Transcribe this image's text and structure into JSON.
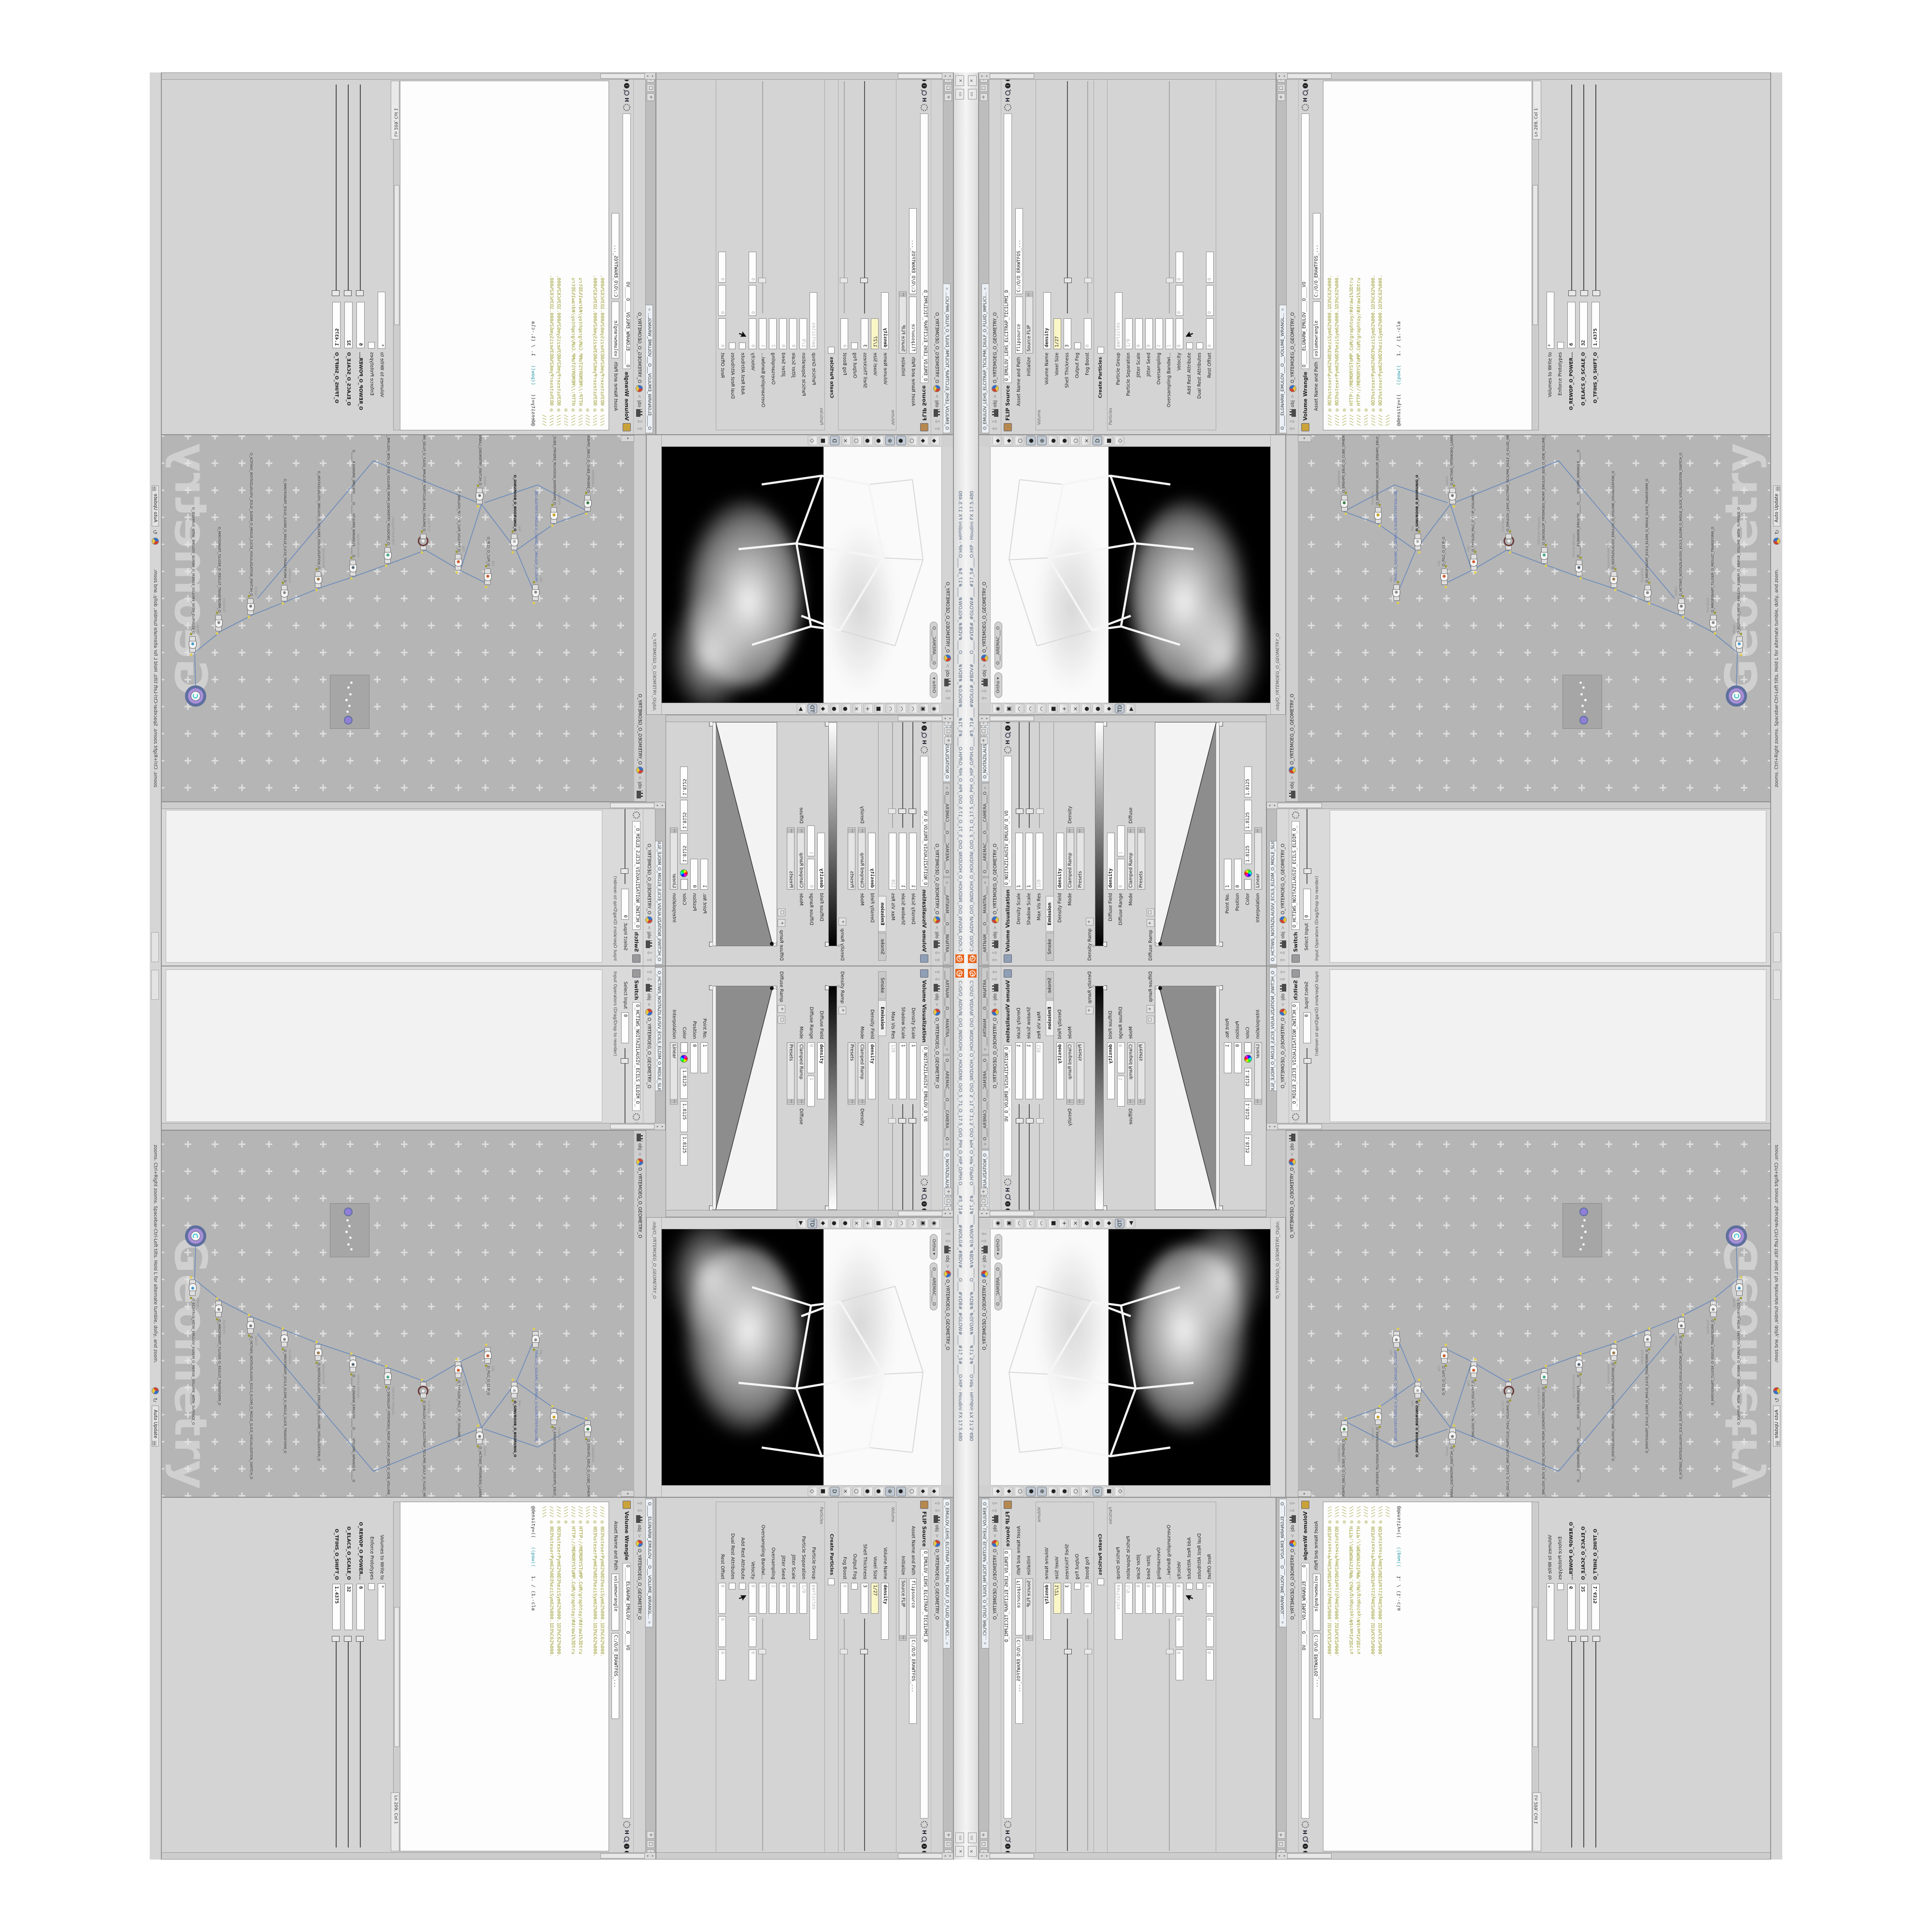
{
  "window": {
    "title": "C:/O/O_AIDIVN_O/O_INIDUOH_O_HOUDINI_O/O_5_71_O_17.5_O/O_PIH_O_HIP_O/PIH.O____#5_71#____#WOLG#_#BDV#____O____#VDB#_#GLOW#____#17_5#____O.HIP - Houdini FX 17.5.480",
    "minimize_label": "▭",
    "close_label": "×"
  },
  "breadcrumb": {
    "up_arrow": "⇧",
    "down_arrow": "⇩",
    "context": "obj",
    "chevron": ">",
    "path": "O_YRTEMOEG_O_GEOMETRY_O"
  },
  "pane_controls": {
    "pin": "+",
    "maximize": "□",
    "collapse": "◁"
  },
  "volviz": {
    "tabs": [
      {
        "label": "____ARTNAM____O____MANTRA____",
        "x": "×"
      },
      {
        "label": "O____AREMAC____O____CAMERA____O",
        "x": "×"
      },
      {
        "label": "O_NOITAZILAUSIV_E...",
        "x": "×",
        "act": "1"
      }
    ],
    "header": {
      "title": "Volume Visualization",
      "name": "O_NOITAZILAUSIV_EMULOV_O_VO"
    },
    "rows1": [
      {
        "label": "Density Scale",
        "v1": "1",
        "cls": "sl"
      },
      {
        "label": "Shadow Scale",
        "v1": "1",
        "cls": "sl"
      },
      {
        "label": "Max Vis Res",
        "v1": "128",
        "cls": "sl dis"
      }
    ],
    "folder_tabs": [
      {
        "label": "Smoke"
      },
      {
        "label": "Emission",
        "act": "1"
      }
    ],
    "rows2": [
      {
        "label": "Density Field",
        "v1": "density",
        "cls": "bold1"
      },
      {
        "label": "Mode",
        "v1": "Clamped Ramp",
        "v2": "Density",
        "cls": "drop p2"
      },
      {
        "label": "",
        "v1": "Presets",
        "cls": "drop"
      }
    ],
    "density_ramp_label": "Density Ramp",
    "rows3": [
      {
        "label": "Diffuse Field",
        "v1": "density",
        "cls": "bold1"
      },
      {
        "label": "Diffuse Range",
        "v1": "0",
        "v2": "1",
        "cls": "dis nar"
      },
      {
        "label": "Mode",
        "v1": "Clamped Ramp",
        "v2": "Diffuse",
        "cls": "drop p2"
      },
      {
        "label": "",
        "v1": "Presets",
        "cls": "drop"
      }
    ],
    "diffuse_ramp_label": "Diffuse Ramp",
    "ramp_add": "+",
    "ramp_del": "□",
    "ramp_marker": "▽",
    "rows4": [
      {
        "label": "Point No.",
        "v1": "1",
        "cls": "nar"
      },
      {
        "label": "Position",
        "v1": "0",
        "cls": "nar"
      }
    ],
    "color": {
      "label": "Color",
      "r": "1.8125",
      "g": "1.8125",
      "b": "1.8125"
    },
    "rows5": [
      {
        "label": "Interpolation",
        "v1": "Linear",
        "cls": "drop"
      }
    ]
  },
  "viewport": {
    "pills": [
      {
        "label": "Ortho ▾"
      },
      {
        "label": "O___AREMAC___O"
      }
    ],
    "path": "/obj/O_YRTEMOEG_O_GEOMETRY_O",
    "left_icons": [
      {
        "g": "◉",
        "c": "#666"
      },
      {
        "g": "▣",
        "c": "#888"
      },
      {
        "g": "◠",
        "c": "#b03a2e"
      },
      {
        "g": "◠",
        "c": "#b03a2e"
      },
      {
        "g": "◠",
        "c": "#b03a2e"
      },
      {
        "g": "■",
        "c": "#b03a2e"
      },
      {
        "g": "+",
        "c": "#3a7d44"
      },
      {
        "g": "×",
        "c": "#c9c0c0"
      },
      {
        "g": "●",
        "c": "#aa3333"
      },
      {
        "g": "●",
        "c": "#888888"
      },
      {
        "g": "◆",
        "c": "#cc2222"
      },
      {
        "g": "TD",
        "c": "#445566",
        "p": "1"
      },
      {
        "g": "▶",
        "c": "#999999"
      }
    ],
    "right_icons": [
      {
        "g": "◆",
        "c": "#9a9a9a"
      },
      {
        "g": "◆",
        "c": "#9a9a9a"
      },
      {
        "g": "○",
        "c": "#888888"
      },
      {
        "g": "●",
        "c": "#555555",
        "p": "1"
      },
      {
        "g": "⊕",
        "c": "#444444",
        "p": "1"
      },
      {
        "g": "●",
        "c": "#d8bc3a"
      },
      {
        "g": "●",
        "c": "#aaaaaa"
      },
      {
        "g": "○",
        "c": "#777777"
      },
      {
        "g": "×",
        "c": "#666666"
      },
      {
        "g": "D",
        "c": "#335566",
        "p": "1"
      },
      {
        "g": "■",
        "c": "#4a8f3c"
      },
      {
        "g": "◇",
        "c": "#c9ad3f"
      }
    ],
    "wire_main": "M150 210 L300 120 L452 150 L470 248 L330 300 L158 270 Z M158 270 L120 392 M330 300 L318 420 M470 248 L452 372 M150 210 L180 290 M300 120 L330 300",
    "wire_faint": "M150 210 L118 96 M300 120 L296 38 M452 150 L462 60 M118 96 L296 38 L462 60"
  },
  "flip": {
    "tab": {
      "label": "O_EMULOV_LEHS_ELCITRAP_TICILPMI_DIULF_O_FLUID_IMPLICI...",
      "x": "×"
    },
    "header": {
      "title": "FLIP Source",
      "name": "O_EMULOV_LEHS_ELCITRAP_TICILPMI_D"
    },
    "rows1": [
      {
        "label": "Asset Name and Path",
        "v1": "flipsource",
        "v2": "C:/O/O_ERAWTFOS_...",
        "cls": "wide"
      },
      {
        "label": "Initialize",
        "v1": "Source FLIP",
        "cls": "drop"
      }
    ],
    "frame1": "Volume",
    "rows2": [
      {
        "label": "Volume Name",
        "v1": "density",
        "cls": "bold1"
      },
      {
        "label": "Voxel Size",
        "v1": "1/27",
        "cls": "yellow nar"
      },
      {
        "label": "Shell Thickness",
        "v1": "3",
        "cls": "sl nar"
      },
      {
        "label": "Output Fog",
        "cls": "cb"
      },
      {
        "label": "Fog Boost",
        "v1": "0",
        "cls": "dis sl nar"
      }
    ],
    "create_particles": "Create Particles",
    "frame2": "Particles",
    "rows3": [
      {
        "label": "Particle Group",
        "v1": "particles",
        "cls": "dis"
      },
      {
        "label": "Particle Separation",
        "v1": "1/9",
        "cls": "dis nar"
      },
      {
        "label": "Jitter Scale",
        "v1": "0",
        "cls": "dis nar"
      },
      {
        "label": "Jitter Seed",
        "v1": "0",
        "cls": "dis nar"
      },
      {
        "label": "Oversampling",
        "v1": "2",
        "cls": "dis nar"
      },
      {
        "label": "Oversampling Bandwi...",
        "v1": "1",
        "cls": "dis sl nar"
      },
      {
        "label": "Velocity",
        "v1": "0",
        "v2": "0",
        "v3": "0",
        "cls": "dis nar"
      },
      {
        "label": "Add Rest Attribute",
        "cls": "cb cursor"
      },
      {
        "label": "Dual Rest Attributes",
        "cls": "cb"
      },
      {
        "label": "Rest Offset",
        "v1": "0",
        "v2": "0",
        "v3": "0",
        "cls": "dis nar"
      }
    ]
  },
  "switch_pane": {
    "tab": {
      "label": "O_HCTIWS_NOITAZILAUSIV_ECILS_ELDIM_O_MIDLE_SLICE_VISUALIZATION...",
      "x": "×"
    },
    "header": {
      "title": "Switch",
      "name": "O_HCTIWS_NOITAZILAUSIV_ECILS_ELDIM_O_"
    },
    "rows": [
      {
        "label": "Select Input",
        "v1": "0",
        "cls": "sl nar"
      }
    ],
    "note": "Input Operators (Drag/Drop to reorder)"
  },
  "network": {
    "path": "O_YRTEMOEG_O_GEOMETRY_O",
    "watermark": "Geometry",
    "nodes": [
      {
        "type": "an_CubeSphere",
        "name": "O_EREHPS_EBUC_O_CUBE_SPHERE_O",
        "st": "left:600px;top:88px",
        "dot": "background:#3a7d44"
      },
      {
        "type": "PolyWire",
        "name": "O_EMARFERIW_NOGYLOP_EREHPS_EBUC_O_CUBE_SPHERE_POLYGON_WIREFRAME_O",
        "st": "left:575px;top:158px",
        "dot": "background:#c9a227"
      },
      {
        "type": "File",
        "name": "TRIALS.O_SQUARC_O_GENJS1_0.SLIDIRT.STEP.SQA.OBJ",
        "st": "left:415px;top:196px",
        "dot": "background:#8a8a8a",
        "cls": "blue"
      },
      {
        "type": "Box",
        "name": "O_GINUROOB_O_BOORUNIG_O",
        "st": "left:520px;top:240px",
        "dot": "background:#b0b0b0",
        "cls": "bold"
      },
      {
        "type": "Switch",
        "name": "O_HCTIWS_YRTEMOEG_LANRETXE_LANRETNI_O_INTERNAL_EXTERNAL_GEOMETRY_SWITCH_O",
        "st": "left:615px;top:312px",
        "dot": "background:#7a7a7a"
      },
      {
        "type": "Clip",
        "name": "O_PILC_O_CLIP_O",
        "st": "left:448px;top:295px",
        "dot": "background:#cc5a2a"
      },
      {
        "type": "Clip",
        "name": "O_EMULOV_PILC_O_CLIP_VOLUME_O",
        "st": "left:478px;top:356px",
        "dot": "background:#cc5a2a"
      },
      {
        "type": "FLIP Source",
        "name": "O_EMULOV_LEHS_ELCITRAP_TICILPMI_DIULF_O_FLUID_IMPLICIT_PARTICLE_SHEL_VOLUME_O",
        "st": "left:520px;top:428px",
        "dot": "background:#f0f0f0",
        "cls": "ring"
      },
      {
        "type": "VDB from Polygons",
        "name": "O_SNOGILOP_YRTEMOEG_MORF_EMULOV_BDV_O_VDB_VOLUME_FROM_GEOMETRY_POLYGONS_O",
        "st": "left:492px;top:502px",
        "dot": "background:#44aa88"
      },
      {
        "type": "Volume Wrangle",
        "name": "O_____ELGNARW_EMULOV_____O_____VOLUME_WRANGLE_____O",
        "st": "left:466px;top:574px",
        "dot": "background:#556677"
      },
      {
        "type": "VolumeVisualization",
        "name": "O_NOITAZILAUSIV_EMULOV_O_VOLUME_VISUALIZATION_O",
        "st": "left:442px;top:646px",
        "dot": "background:#997744"
      },
      {
        "type": "Transform",
        "name": "O_MROFSNART_ECILS_ELDIM_O_MIDLE_SLICE_TRANSFORM_O",
        "st": "left:414px;top:716px",
        "dot": "background:#888888"
      },
      {
        "type": "Switch",
        "name": "O_HCTIWS_NOITAZILAUSIV_ECILS_ELDIM_O_MIDLE_SLICE_VISUALIZATION_SWITCH_O",
        "st": "left:386px;top:786px",
        "dot": "background:#7a7a7a"
      },
      {
        "type": "Transform",
        "name": "O_MROFSNART_TLUSER_O_RESULT_TRANSFORM_O",
        "st": "left:352px;top:852px",
        "dot": "background:#888888"
      },
      {
        "type": "Merge",
        "name": "O_ECAFRUS_HTIW_EMULOV_EGREM_O_MERGE_VOLUME_WITH_SURFACE_O",
        "st": "left:308px;top:906px",
        "dot": "background:#4499cc"
      }
    ],
    "wire_path": "M600 95 L575 165 M575 165 L520 244 M415 200 L520 244 M520 244 L615 316 M615 316 L478 360 M448 299 L478 360 M478 360 L520 432 M520 432 L492 506 M492 506 L466 578 M466 578 L442 650 M442 650 L414 720 M414 720 L386 790 M386 790 L352 856 M352 856 L308 910 M308 910 L240 908 M615 316 L705 540 L420 780 M600 95 L655 200 L618 310"
  },
  "wrangle": {
    "tab": {
      "label": "O_____ELGNARW_EMULOV___O___VOLUME_WRANGL...",
      "x": "×"
    },
    "header": {
      "title": "Volume Wrangle",
      "name": "O_____ELGNARW_EMULOV____O____VO"
    },
    "asset": {
      "label": "Asset Name and Path",
      "v1": "volumewrangle",
      "v2": "C:/O/O_ERAWTFOS_...",
      "cls": "wide"
    },
    "code_lines": [
      {
        "t": "//// ◎ 0D3%steserPym62%0D3%eziSym62%000.1D3%C62%000."
      },
      {
        "t": "//// ◎ 0D3%steserPym62%0D3%eziSym62%000.1D3%C62%000."
      },
      {
        "t": "\\\\\\\\ ◎"
      },
      {
        "t": "//// ◎ HTTP://MEMORYST◎MP.C◎M/graphtoy/#draw1%3Dtru"
      },
      {
        "t": "//// ◎ HTTP://MEMORYST◎MP.C◎M/graphtoy/#draw1%3Dtru"
      },
      {
        "t": "\\\\\\\\ ◎"
      },
      {
        "t": "//// ◎ 0D3%steserPym62%0D3%eziSym62%000.1D3%C62%000."
      },
      {
        "t": "//// ◎ 0D3%steserPym62%0D3%eziSym62%000.1D3%C62%000."
      },
      {
        "t": "\\\\\\\\"
      }
    ],
    "code_tail": {
      "a": "@density=((",
      "b": "((pow((",
      "c": "1. / (1.-cla"
    },
    "ln": "Ln 209, Col 1",
    "volumes": {
      "label": "Volumes to Write to",
      "v1": "*"
    },
    "enforce": "Enforce Prototypes",
    "sliders": [
      {
        "label": "O_REWOP_O_POWER...",
        "v": "6"
      },
      {
        "label": "O_ELACS_O_SCALE_O",
        "v": "32"
      },
      {
        "label": "O_TFIHS_O_SHIFT_O",
        "v": "1.4375"
      }
    ]
  },
  "status": {
    "hint": "zooms. Ctrl+Right zooms. Spacebar-Ctrl-Left tilts. Hold L for alternate tumble, dolly, and zoom.",
    "auto_update": "Auto Update",
    "refresh_icon": "↻"
  }
}
